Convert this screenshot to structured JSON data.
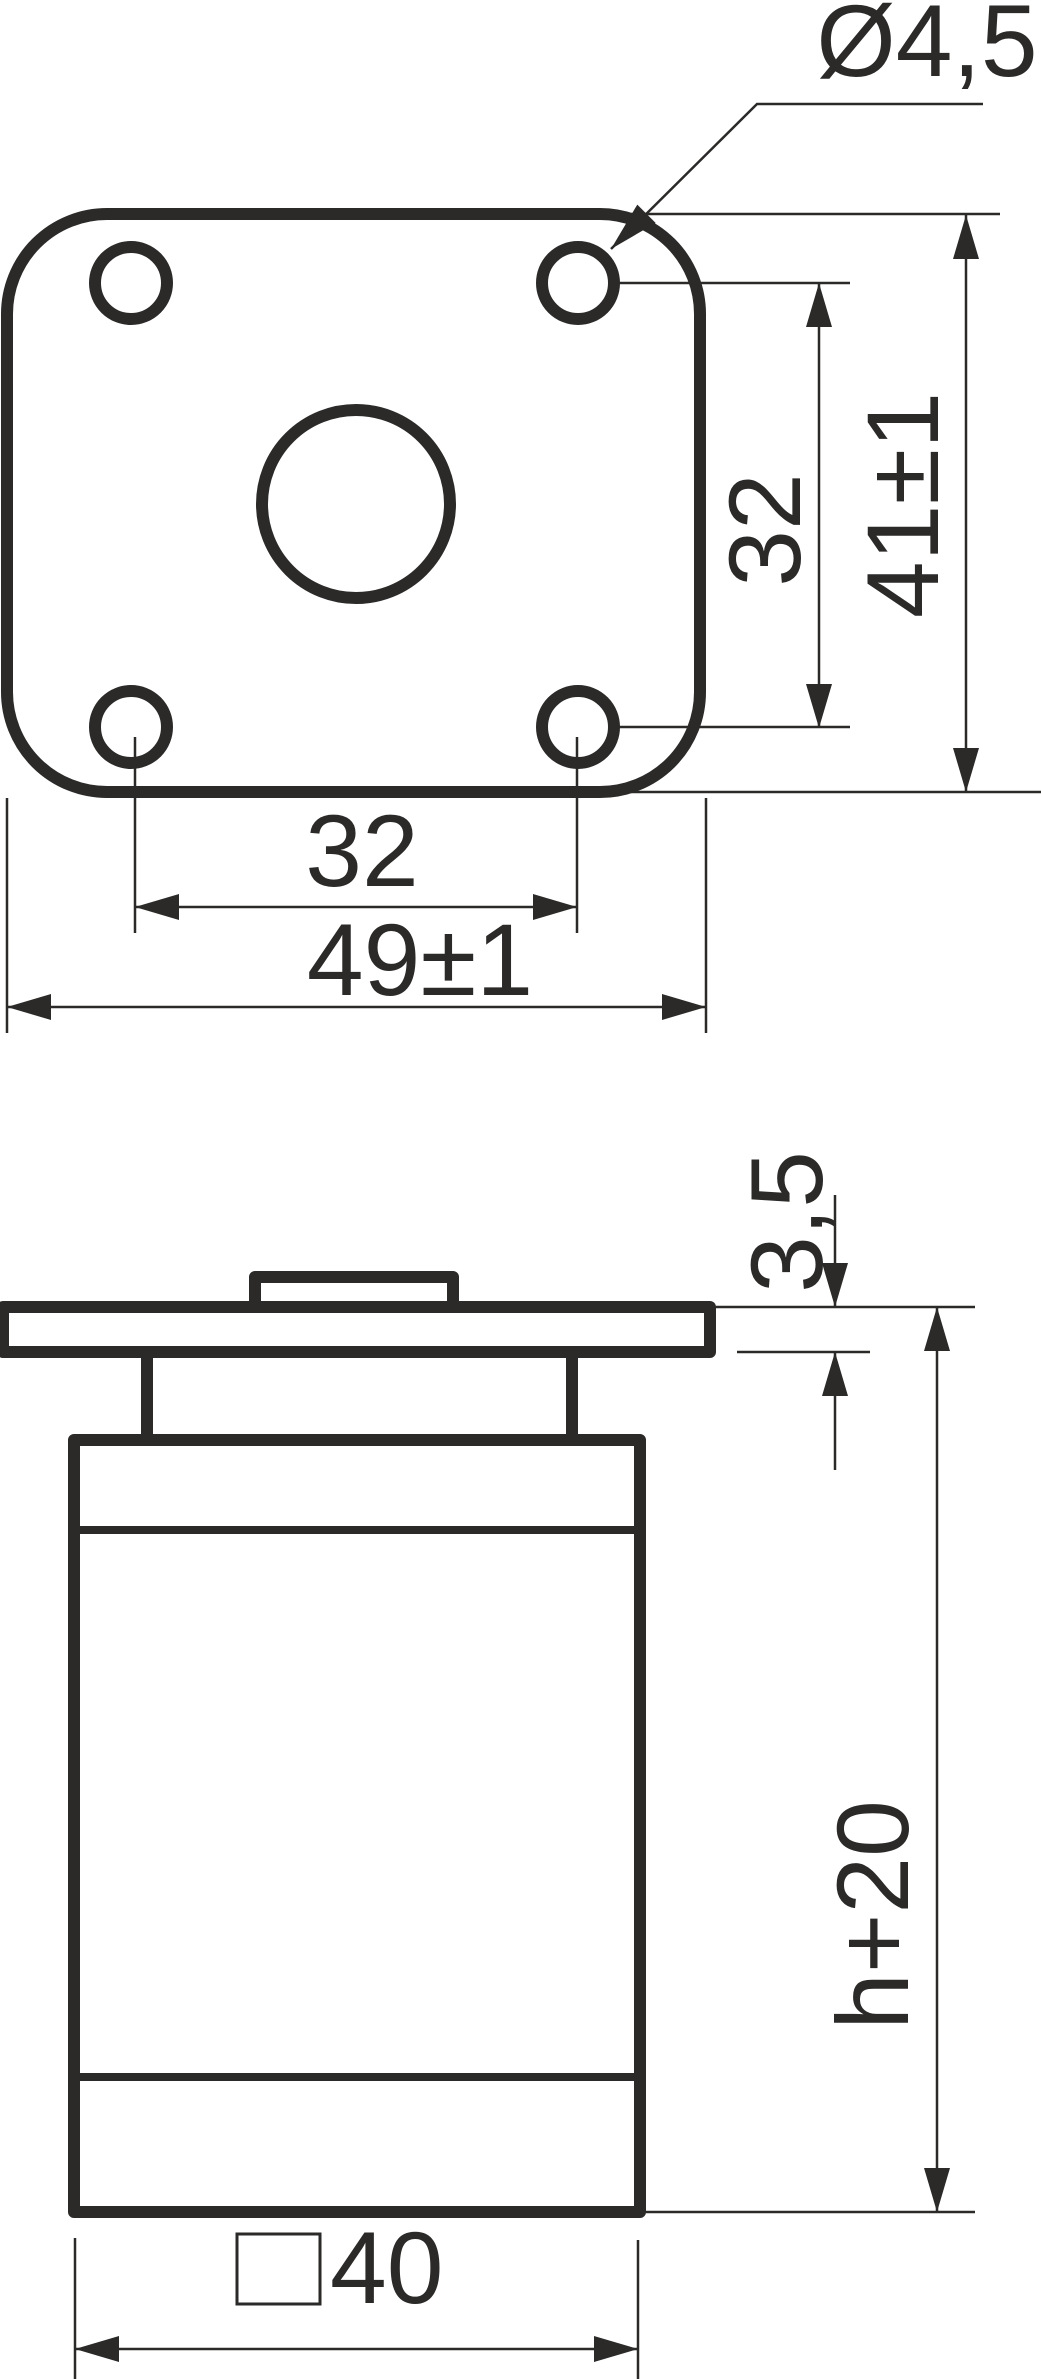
{
  "colors": {
    "ink": "#2b2a29",
    "paper": "#ffffff"
  },
  "drawing": {
    "kind": "technical drawing, furniture leg with mounting flange, two orthographic views"
  },
  "top_view": {
    "name": "mounting plate top view",
    "labels": {
      "hole_diameter": "Ø4,5",
      "hole_pitch_vertical": "32",
      "plate_depth": "41±1",
      "hole_pitch_horizontal": "32",
      "plate_width": "49±1"
    }
  },
  "side_view": {
    "name": "leg side view",
    "labels": {
      "flange_thickness": "3,5",
      "overall_height": "h+20",
      "section_symbol": "□",
      "section_size": "40"
    }
  }
}
